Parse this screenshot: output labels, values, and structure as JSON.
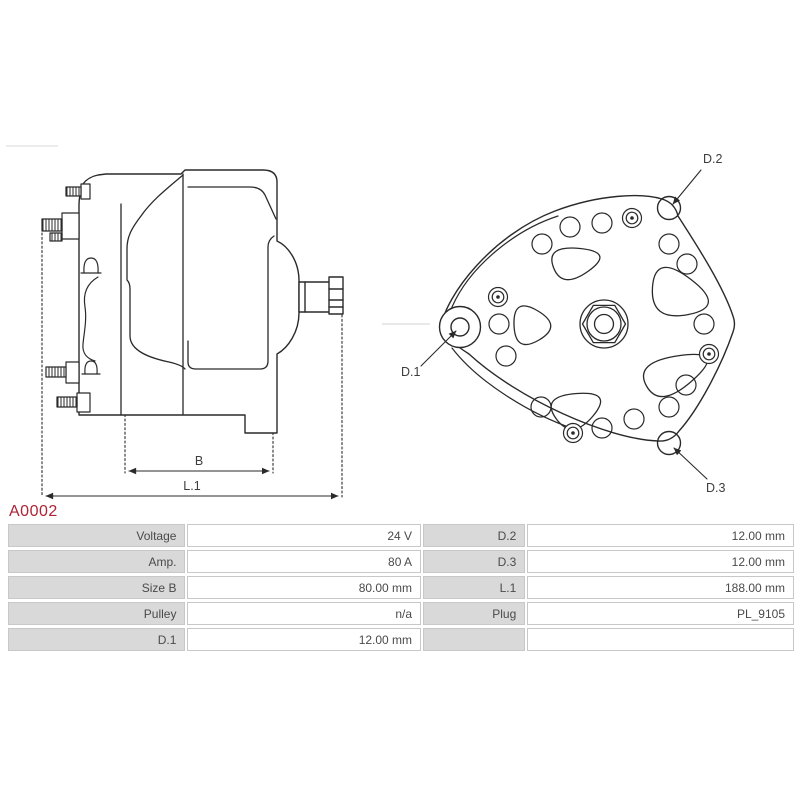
{
  "part": {
    "code": "A0002"
  },
  "colors": {
    "accent_red": "#ae2335",
    "drawing_line": "#2a2a2a",
    "table_label_bg": "#d9d9d9",
    "table_border": "#c8c8c8",
    "table_text": "#4a4a4a"
  },
  "side_view": {
    "dim_b": "B",
    "dim_l1": "L.1"
  },
  "front_view": {
    "d1": "D.1",
    "d2": "D.2",
    "d3": "D.3"
  },
  "spec_table": {
    "rows": [
      {
        "label1": "Voltage",
        "value1": "24 V",
        "label2": "D.2",
        "value2": "12.00 mm"
      },
      {
        "label1": "Amp.",
        "value1": "80 A",
        "label2": "D.3",
        "value2": "12.00 mm"
      },
      {
        "label1": "Size B",
        "value1": "80.00 mm",
        "label2": "L.1",
        "value2": "188.00 mm"
      },
      {
        "label1": "Pulley",
        "value1": "n/a",
        "label2": "Plug",
        "value2": "PL_9105"
      },
      {
        "label1": "D.1",
        "value1": "12.00 mm",
        "label2": "",
        "value2": ""
      }
    ]
  }
}
